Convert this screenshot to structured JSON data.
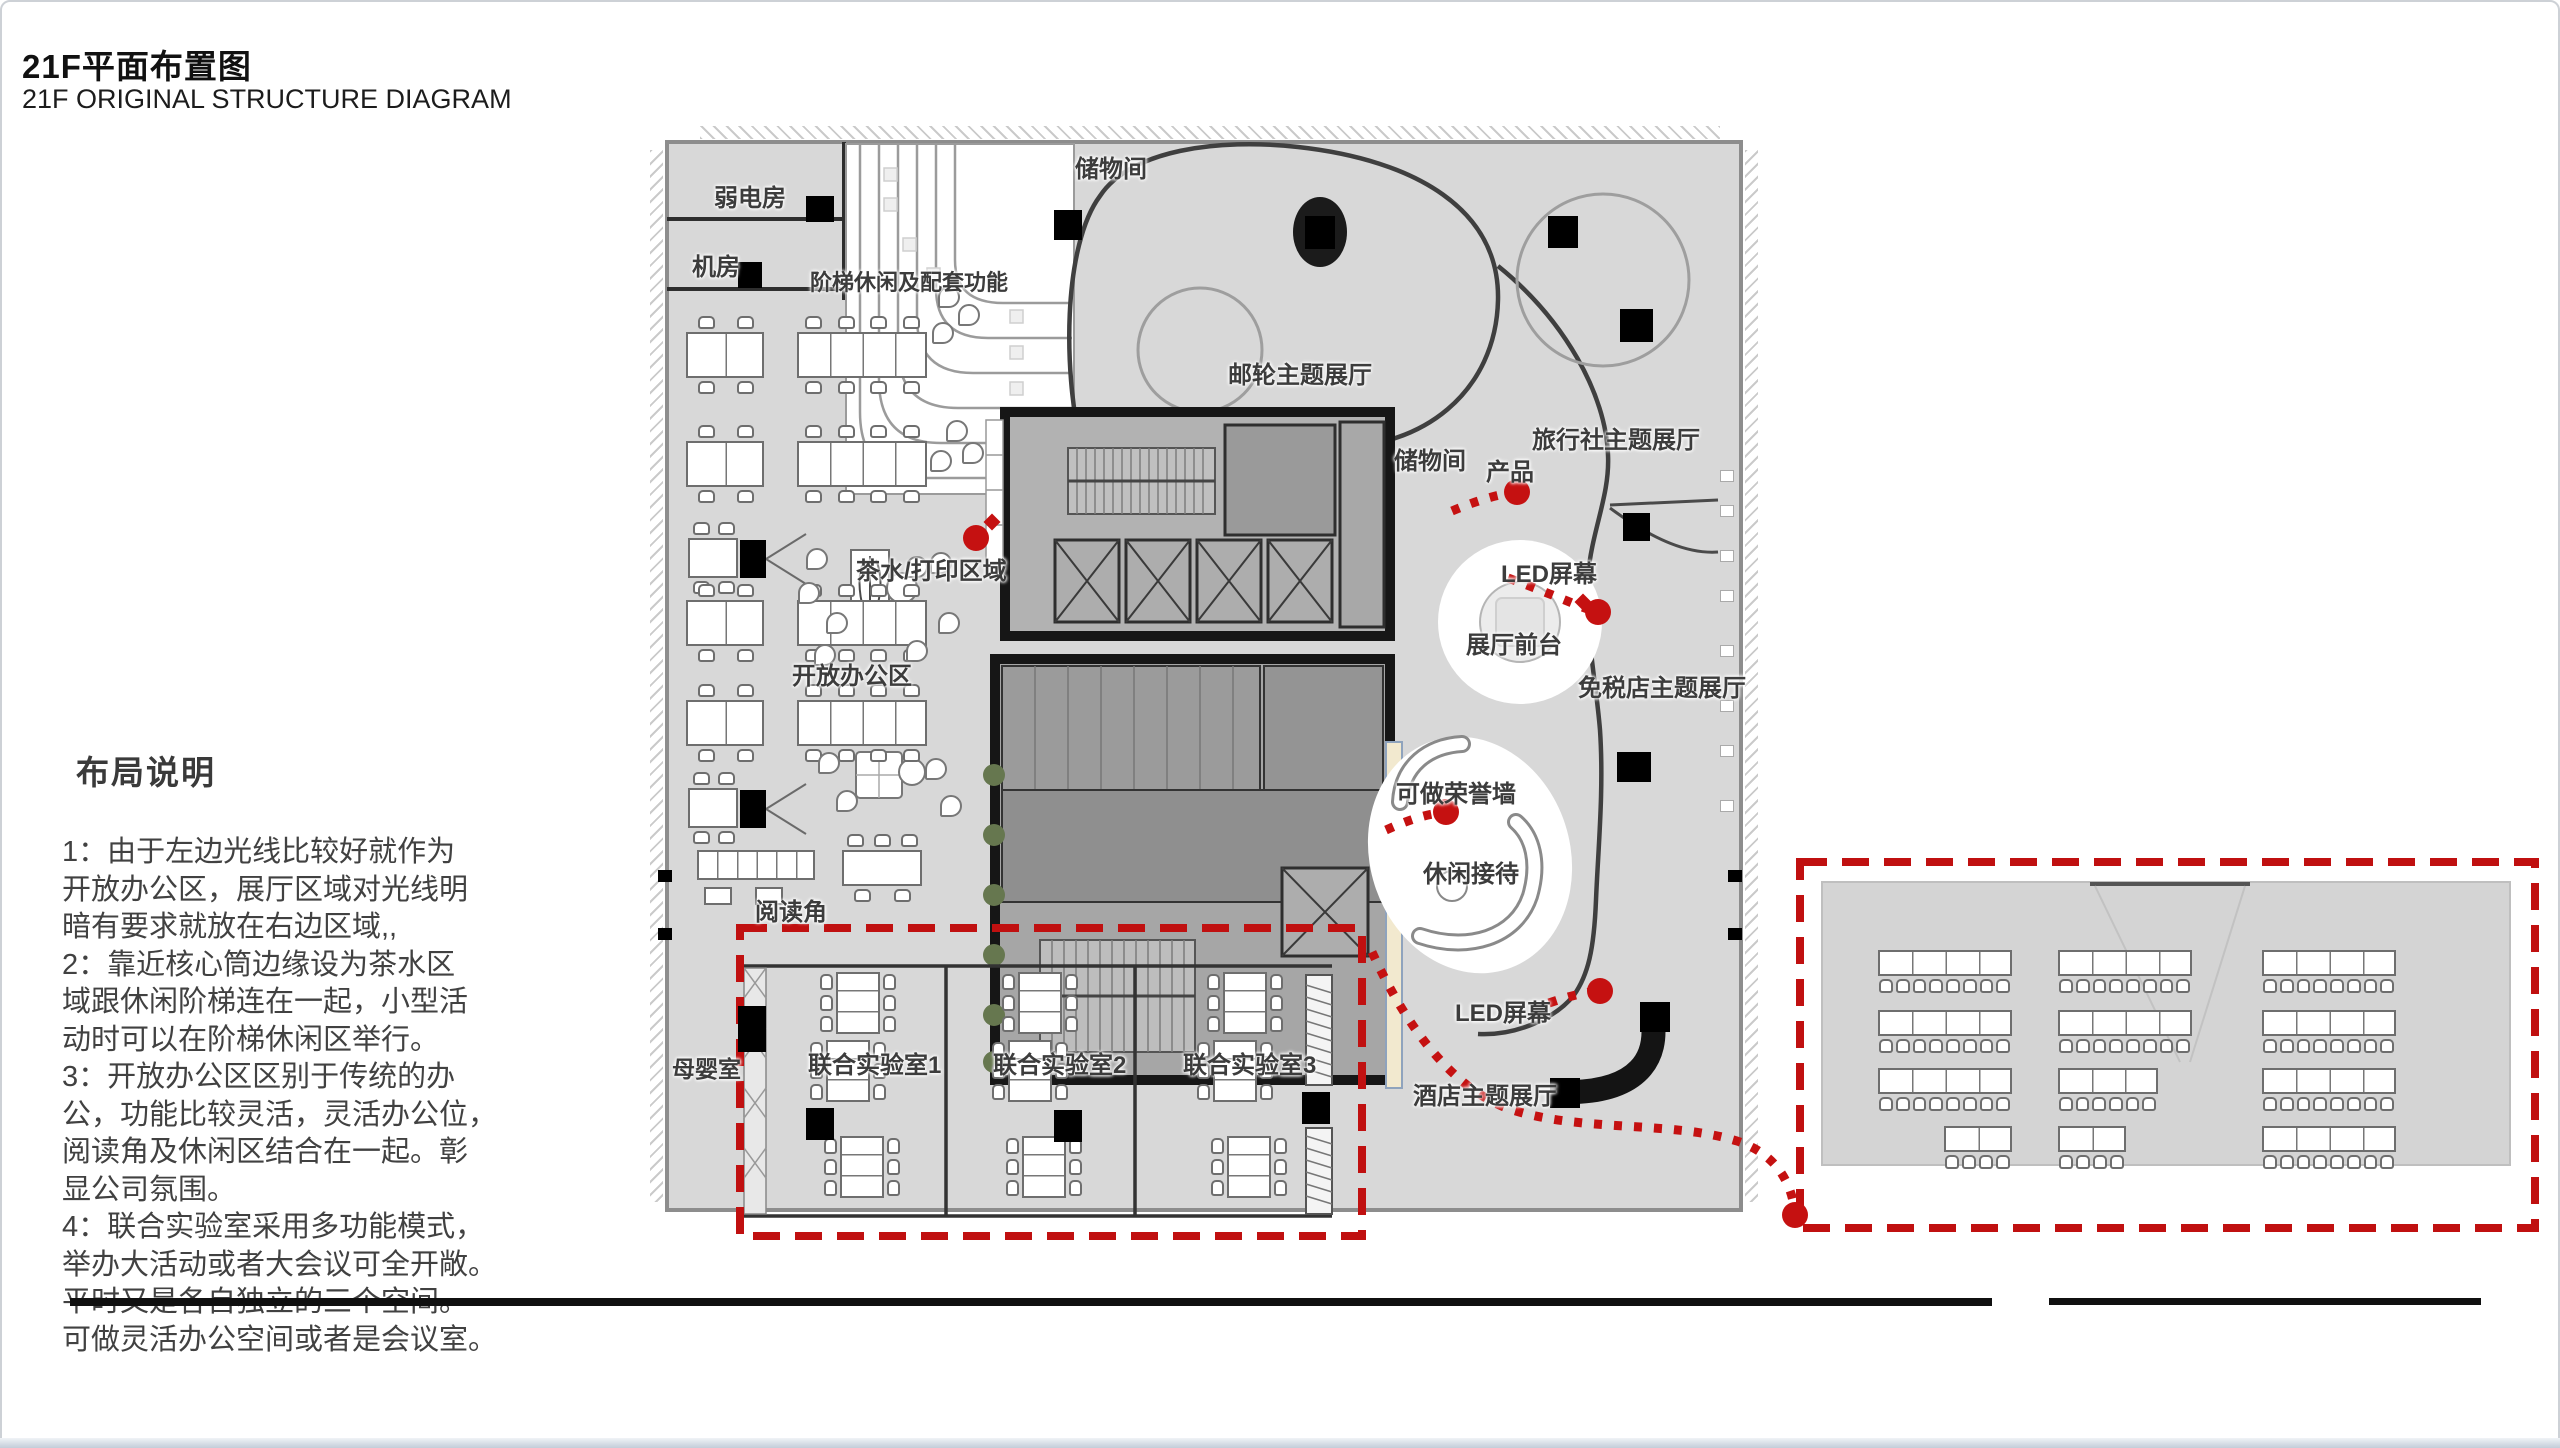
{
  "title": {
    "cn": "21F平面布置图",
    "en": "21F ORIGINAL STRUCTURE DIAGRAM"
  },
  "notes": {
    "heading": "布局说明",
    "lines": [
      "1：由于左边光线比较好就作为",
      "开放办公区，展厅区域对光线明",
      "暗有要求就放在右边区域,,",
      "2：靠近核心筒边缘设为茶水区",
      "域跟休闲阶梯连在一起，小型活",
      "动时可以在阶梯休闲区举行。",
      "3：开放办公区区别于传统的办",
      "公，功能比较灵活，灵活办公位，",
      "阅读角及休闲区结合在一起。彰",
      "显公司氛围。",
      "4：联合实验室采用多功能模式，",
      "举办大活动或者大会议可全开敞。",
      "平时又是各自独立的三个空间。",
      "可做灵活办公空间或者是会议室。"
    ]
  },
  "colors": {
    "red": "#c51111",
    "dashed_red": "#c01010",
    "floor": "#d8d8d8",
    "core_fill": "#b2b2b2",
    "wall_dark": "#161616",
    "curve": "#3f3f3f",
    "honor_wall": "#f2e9cf"
  },
  "plan_labels": [
    {
      "id": "weak-power-room",
      "text": "弱电房",
      "x": 714,
      "y": 178,
      "s": 24
    },
    {
      "id": "machine-room",
      "text": "机房",
      "x": 692,
      "y": 247,
      "s": 24
    },
    {
      "id": "stair-leisure",
      "text": "阶梯休闲及配套功能",
      "x": 810,
      "y": 265,
      "s": 22
    },
    {
      "id": "storage-top",
      "text": "储物间",
      "x": 1075,
      "y": 149,
      "s": 24
    },
    {
      "id": "cruise-hall",
      "text": "邮轮主题展厅",
      "x": 1228,
      "y": 355,
      "s": 24
    },
    {
      "id": "travel-hall",
      "text": "旅行社主题展厅",
      "x": 1532,
      "y": 420,
      "s": 24
    },
    {
      "id": "storage-mid",
      "text": "储物间",
      "x": 1394,
      "y": 441,
      "s": 24
    },
    {
      "id": "product",
      "text": "产品",
      "x": 1486,
      "y": 452,
      "s": 24
    },
    {
      "id": "tea-print",
      "text": "茶水/打印区域",
      "x": 856,
      "y": 551,
      "s": 24
    },
    {
      "id": "led-screen-1",
      "text": "LED屏幕",
      "x": 1501,
      "y": 554,
      "s": 24
    },
    {
      "id": "hall-reception",
      "text": "展厅前台",
      "x": 1466,
      "y": 625,
      "s": 24
    },
    {
      "id": "duty-free-hall",
      "text": "免税店主题展厅",
      "x": 1578,
      "y": 668,
      "s": 24
    },
    {
      "id": "open-office",
      "text": "开放办公区",
      "x": 792,
      "y": 656,
      "s": 24
    },
    {
      "id": "honor-wall",
      "text": "可做荣誉墙",
      "x": 1396,
      "y": 774,
      "s": 24
    },
    {
      "id": "leisure-reception",
      "text": "休闲接待",
      "x": 1423,
      "y": 854,
      "s": 24
    },
    {
      "id": "reading-corner",
      "text": "阅读角",
      "x": 755,
      "y": 892,
      "s": 24
    },
    {
      "id": "nursing-room",
      "text": "母婴室",
      "x": 672,
      "y": 1050,
      "s": 23
    },
    {
      "id": "joint-lab-1",
      "text": "联合实验室1",
      "x": 808,
      "y": 1045,
      "s": 24
    },
    {
      "id": "joint-lab-2",
      "text": "联合实验室2",
      "x": 993,
      "y": 1045,
      "s": 24
    },
    {
      "id": "joint-lab-3",
      "text": "联合实验室3",
      "x": 1183,
      "y": 1045,
      "s": 24
    },
    {
      "id": "led-screen-2",
      "text": "LED屏幕",
      "x": 1455,
      "y": 993,
      "s": 24
    },
    {
      "id": "hotel-hall",
      "text": "酒店主题展厅",
      "x": 1413,
      "y": 1076,
      "s": 24
    }
  ],
  "furniture": {
    "office_desks": [
      {
        "x": 686,
        "y": 332,
        "w": 78,
        "h": 46,
        "seg": 2,
        "top": 2,
        "bot": 2
      },
      {
        "x": 686,
        "y": 441,
        "w": 78,
        "h": 46,
        "seg": 2,
        "top": 2,
        "bot": 2
      },
      {
        "x": 688,
        "y": 538,
        "w": 50,
        "h": 40,
        "seg": 1,
        "top": 2,
        "bot": 2
      },
      {
        "x": 686,
        "y": 600,
        "w": 78,
        "h": 46,
        "seg": 2,
        "top": 2,
        "bot": 2
      },
      {
        "x": 686,
        "y": 700,
        "w": 78,
        "h": 46,
        "seg": 2,
        "top": 2,
        "bot": 2
      },
      {
        "x": 688,
        "y": 788,
        "w": 50,
        "h": 40,
        "seg": 1,
        "top": 2,
        "bot": 2
      },
      {
        "x": 797,
        "y": 332,
        "w": 130,
        "h": 46,
        "seg": 4,
        "top": 4,
        "bot": 4
      },
      {
        "x": 797,
        "y": 441,
        "w": 130,
        "h": 46,
        "seg": 4,
        "top": 4,
        "bot": 4
      },
      {
        "x": 797,
        "y": 600,
        "w": 130,
        "h": 46,
        "seg": 4,
        "top": 4,
        "bot": 4
      },
      {
        "x": 797,
        "y": 700,
        "w": 130,
        "h": 46,
        "seg": 4,
        "top": 4,
        "bot": 4
      },
      {
        "x": 842,
        "y": 850,
        "w": 80,
        "h": 36,
        "seg": 1,
        "top": 3,
        "bot": 2
      },
      {
        "x": 697,
        "y": 850,
        "w": 118,
        "h": 30,
        "seg": 6,
        "top": 0,
        "bot": 0
      }
    ],
    "lab_tables": [
      {
        "x": 836,
        "y": 972
      },
      {
        "x": 826,
        "y": 1040
      },
      {
        "x": 840,
        "y": 1136
      },
      {
        "x": 1018,
        "y": 972
      },
      {
        "x": 1008,
        "y": 1040
      },
      {
        "x": 1022,
        "y": 1136
      },
      {
        "x": 1223,
        "y": 972
      },
      {
        "x": 1213,
        "y": 1040
      },
      {
        "x": 1227,
        "y": 1136
      }
    ],
    "classroom_rows": [
      {
        "x": 1878,
        "y": 950,
        "w": 134,
        "seg": 4
      },
      {
        "x": 1878,
        "y": 1010,
        "w": 134,
        "seg": 4
      },
      {
        "x": 1878,
        "y": 1068,
        "w": 134,
        "seg": 4
      },
      {
        "x": 1944,
        "y": 1126,
        "w": 68,
        "seg": 2
      },
      {
        "x": 2058,
        "y": 950,
        "w": 134,
        "seg": 4
      },
      {
        "x": 2058,
        "y": 1010,
        "w": 134,
        "seg": 4
      },
      {
        "x": 2058,
        "y": 1068,
        "w": 100,
        "seg": 3
      },
      {
        "x": 2058,
        "y": 1126,
        "w": 68,
        "seg": 2
      },
      {
        "x": 2262,
        "y": 950,
        "w": 134,
        "seg": 4
      },
      {
        "x": 2262,
        "y": 1010,
        "w": 134,
        "seg": 4
      },
      {
        "x": 2262,
        "y": 1068,
        "w": 134,
        "seg": 4
      },
      {
        "x": 2262,
        "y": 1126,
        "w": 134,
        "seg": 4
      }
    ],
    "black_blocks": [
      {
        "x": 806,
        "y": 196,
        "w": 28,
        "h": 26
      },
      {
        "x": 738,
        "y": 262,
        "w": 24,
        "h": 26
      },
      {
        "x": 1054,
        "y": 210,
        "w": 28,
        "h": 30
      },
      {
        "x": 1548,
        "y": 216,
        "w": 30,
        "h": 32
      },
      {
        "x": 1620,
        "y": 309,
        "w": 33,
        "h": 33
      },
      {
        "x": 1623,
        "y": 513,
        "w": 27,
        "h": 28
      },
      {
        "x": 1617,
        "y": 752,
        "w": 34,
        "h": 30
      },
      {
        "x": 1640,
        "y": 1002,
        "w": 30,
        "h": 30
      },
      {
        "x": 1550,
        "y": 1078,
        "w": 30,
        "h": 30
      },
      {
        "x": 738,
        "y": 1006,
        "w": 28,
        "h": 46
      },
      {
        "x": 806,
        "y": 1108,
        "w": 28,
        "h": 32
      },
      {
        "x": 1054,
        "y": 1110,
        "w": 28,
        "h": 32
      },
      {
        "x": 1302,
        "y": 1092,
        "w": 28,
        "h": 32
      },
      {
        "x": 658,
        "y": 870,
        "w": 14,
        "h": 12
      },
      {
        "x": 658,
        "y": 928,
        "w": 14,
        "h": 12
      },
      {
        "x": 1728,
        "y": 870,
        "w": 14,
        "h": 12
      },
      {
        "x": 1728,
        "y": 928,
        "w": 14,
        "h": 12
      }
    ],
    "stools": [
      {
        "x": 806,
        "y": 548
      },
      {
        "x": 798,
        "y": 582
      },
      {
        "x": 826,
        "y": 612
      },
      {
        "x": 814,
        "y": 644
      },
      {
        "x": 906,
        "y": 556
      },
      {
        "x": 930,
        "y": 552
      },
      {
        "x": 938,
        "y": 612
      },
      {
        "x": 906,
        "y": 640
      },
      {
        "x": 938,
        "y": 286
      },
      {
        "x": 958,
        "y": 304
      },
      {
        "x": 932,
        "y": 322
      },
      {
        "x": 946,
        "y": 420
      },
      {
        "x": 962,
        "y": 442
      },
      {
        "x": 930,
        "y": 450
      },
      {
        "x": 818,
        "y": 752
      },
      {
        "x": 836,
        "y": 790
      },
      {
        "x": 925,
        "y": 758
      },
      {
        "x": 940,
        "y": 795
      }
    ],
    "window_slits": [
      {
        "x": 1720,
        "y": 470
      },
      {
        "x": 1720,
        "y": 505
      },
      {
        "x": 1720,
        "y": 550
      },
      {
        "x": 1720,
        "y": 590
      },
      {
        "x": 1720,
        "y": 645
      },
      {
        "x": 1720,
        "y": 700
      },
      {
        "x": 1720,
        "y": 745
      },
      {
        "x": 1720,
        "y": 800
      }
    ]
  },
  "annotations": {
    "red_dots": [
      {
        "x": 976,
        "y": 538
      },
      {
        "x": 1517,
        "y": 492
      },
      {
        "x": 1598,
        "y": 612
      },
      {
        "x": 1446,
        "y": 812
      },
      {
        "x": 1600,
        "y": 991
      },
      {
        "x": 1795,
        "y": 1215
      }
    ],
    "red_diamonds": [
      {
        "x": 992,
        "y": 522
      },
      {
        "x": 1583,
        "y": 602
      }
    ]
  }
}
